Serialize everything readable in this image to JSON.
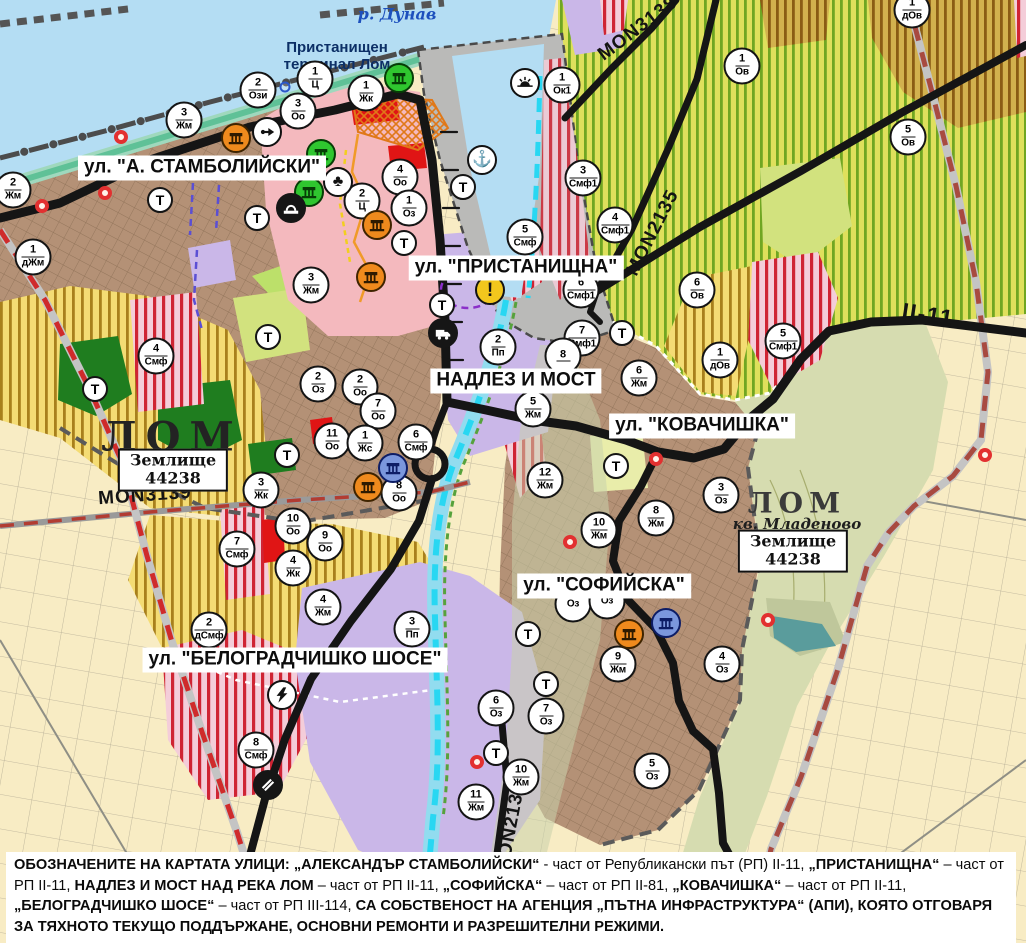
{
  "map_title": "Устройствен план – гр. Лом",
  "palette": {
    "water": "#b4ddf3",
    "river_channel": "#28d7f2",
    "residential_brown": "#b49176",
    "production_purple": "#cab7e8",
    "park_green": "#2fc62f",
    "mixed_function_stripe": "#cf2433",
    "agriculture_yellow": "#f4dc74",
    "vineyard_green": "#70a622",
    "central_pink": "#f4b9be",
    "port_gray": "#babab8",
    "road_black": "#151515",
    "railway_red": "#cf2b2b"
  },
  "street_labels": [
    {
      "text": "ул. \"А. СТАМБОЛИЙСКИ\"",
      "x": 202,
      "y": 168
    },
    {
      "text": "ул. \"ПРИСТАНИЩНА\"",
      "x": 516,
      "y": 268
    },
    {
      "text": "НАДЛЕЗ И МОСТ",
      "x": 516,
      "y": 381
    },
    {
      "text": "ул. \"КОВАЧИШКА\"",
      "x": 702,
      "y": 426
    },
    {
      "text": "ул. \"СОФИЙСКА\"",
      "x": 604,
      "y": 586
    },
    {
      "text": "ул. \"БЕЛОГРАДЧИШКО ШОСЕ\"",
      "x": 295,
      "y": 660
    }
  ],
  "road_labels": [
    {
      "text": "MON3139",
      "x": 145,
      "y": 496,
      "rot": -4
    },
    {
      "text": "MON3138",
      "x": 638,
      "y": 29,
      "rot": -37
    },
    {
      "text": "MON2135",
      "x": 653,
      "y": 233,
      "rot": -63
    },
    {
      "text": "MON2136",
      "x": 511,
      "y": 828,
      "rot": -79
    },
    {
      "text": "II-11",
      "x": 928,
      "y": 315,
      "rot": 9,
      "cls": "big"
    }
  ],
  "place_labels": [
    {
      "text": "р. Дунав",
      "x": 397,
      "y": 14,
      "cls": "river-name",
      "name": "danube-river-label"
    },
    {
      "text": "Пристанищен\nтерминал Лом",
      "x": 337,
      "y": 56,
      "cls": "terminal",
      "name": "port-terminal-label"
    },
    {
      "text": "ЛОМ",
      "x": 172,
      "y": 437,
      "cls": "city-large",
      "name": "city-label-lom"
    },
    {
      "text": "ЛОМ",
      "x": 797,
      "y": 503,
      "cls": "city-small",
      "name": "city-label-lom-mladenovo"
    },
    {
      "text": "кв. Младеново",
      "x": 797,
      "y": 524,
      "cls": "quarter",
      "name": "quarter-mladenovo-label"
    }
  ],
  "land_boxes": [
    {
      "line1": "Землище",
      "line2": "44238",
      "x": 173,
      "y": 470
    },
    {
      "line1": "Землище",
      "line2": "44238",
      "x": 793,
      "y": 551
    }
  ],
  "markers": {
    "zone": [
      {
        "num": "2",
        "code": "Ози",
        "x": 258,
        "y": 90
      },
      {
        "num": "1",
        "code": "Ц",
        "x": 315,
        "y": 79
      },
      {
        "num": "1",
        "code": "Жк",
        "x": 366,
        "y": 93
      },
      {
        "num": "3",
        "code": "Оо",
        "x": 298,
        "y": 111
      },
      {
        "num": "3",
        "code": "Жм",
        "x": 184,
        "y": 120
      },
      {
        "num": "2",
        "code": "Жм",
        "x": 13,
        "y": 190
      },
      {
        "num": "1",
        "code": "дЖм",
        "x": 33,
        "y": 257
      },
      {
        "num": "4",
        "code": "Оо",
        "x": 400,
        "y": 177
      },
      {
        "num": "2",
        "code": "Ц",
        "x": 362,
        "y": 201
      },
      {
        "num": "1",
        "code": "Оз",
        "x": 409,
        "y": 208
      },
      {
        "num": "3",
        "code": "Жм",
        "x": 311,
        "y": 285
      },
      {
        "num": "1",
        "code": "Ок1",
        "x": 562,
        "y": 85
      },
      {
        "num": "3",
        "code": "Смф1",
        "x": 583,
        "y": 178
      },
      {
        "num": "4",
        "code": "Смф1",
        "x": 615,
        "y": 225
      },
      {
        "num": "5",
        "code": "Смф",
        "x": 525,
        "y": 237
      },
      {
        "num": "6",
        "code": "Смф1",
        "x": 581,
        "y": 290
      },
      {
        "num": "7",
        "code": "Смф1",
        "x": 582,
        "y": 338
      },
      {
        "num": "8",
        "code": "",
        "x": 563,
        "y": 356
      },
      {
        "num": "1",
        "code": "Ов",
        "x": 742,
        "y": 66
      },
      {
        "num": "1",
        "code": "дОв",
        "x": 912,
        "y": 10
      },
      {
        "num": "5",
        "code": "Ов",
        "x": 908,
        "y": 137
      },
      {
        "num": "6",
        "code": "Ов",
        "x": 697,
        "y": 290
      },
      {
        "num": "1",
        "code": "дОв",
        "x": 720,
        "y": 360
      },
      {
        "num": "5",
        "code": "Смф1",
        "x": 783,
        "y": 341
      },
      {
        "num": "2",
        "code": "Пп",
        "x": 498,
        "y": 347
      },
      {
        "num": "6",
        "code": "Жм",
        "x": 639,
        "y": 378
      },
      {
        "num": "5",
        "code": "Жм",
        "x": 533,
        "y": 409
      },
      {
        "num": "6",
        "code": "Смф",
        "x": 416,
        "y": 442
      },
      {
        "num": "12",
        "code": "Жм",
        "x": 545,
        "y": 480
      },
      {
        "num": "2",
        "code": "Оз",
        "x": 318,
        "y": 384
      },
      {
        "num": "2",
        "code": "Оо",
        "x": 360,
        "y": 387
      },
      {
        "num": "7",
        "code": "Оо",
        "x": 378,
        "y": 411
      },
      {
        "num": "11",
        "code": "Оо",
        "x": 332,
        "y": 441
      },
      {
        "num": "1",
        "code": "Жс",
        "x": 365,
        "y": 443
      },
      {
        "num": "8",
        "code": "Оо",
        "x": 399,
        "y": 493
      },
      {
        "num": "3",
        "code": "Жк",
        "x": 261,
        "y": 490
      },
      {
        "num": "10",
        "code": "Оо",
        "x": 293,
        "y": 526
      },
      {
        "num": "9",
        "code": "Оо",
        "x": 325,
        "y": 543
      },
      {
        "num": "4",
        "code": "Жк",
        "x": 293,
        "y": 568
      },
      {
        "num": "7",
        "code": "Смф",
        "x": 237,
        "y": 549
      },
      {
        "num": "4",
        "code": "Смф",
        "x": 156,
        "y": 356
      },
      {
        "num": "4",
        "code": "Жм",
        "x": 323,
        "y": 607
      },
      {
        "num": "2",
        "code": "дСмф",
        "x": 209,
        "y": 630
      },
      {
        "num": "3",
        "code": "Пп",
        "x": 412,
        "y": 629
      },
      {
        "num": "8",
        "code": "Смф",
        "x": 256,
        "y": 750
      },
      {
        "num": "10",
        "code": "Жм",
        "x": 599,
        "y": 530
      },
      {
        "num": "8",
        "code": "Жм",
        "x": 656,
        "y": 518
      },
      {
        "num": "3",
        "code": "Оз",
        "x": 721,
        "y": 495
      },
      {
        "num": "",
        "code": "Оз",
        "x": 573,
        "y": 604
      },
      {
        "num": "",
        "code": "Оз",
        "x": 607,
        "y": 601
      },
      {
        "num": "9",
        "code": "Жм",
        "x": 618,
        "y": 664
      },
      {
        "num": "4",
        "code": "Оз",
        "x": 722,
        "y": 664
      },
      {
        "num": "6",
        "code": "Оз",
        "x": 496,
        "y": 708
      },
      {
        "num": "7",
        "code": "Оз",
        "x": 546,
        "y": 716
      },
      {
        "num": "10",
        "code": "Жм",
        "x": 521,
        "y": 777
      },
      {
        "num": "11",
        "code": "Жм",
        "x": 476,
        "y": 802
      },
      {
        "num": "5",
        "code": "Оз",
        "x": 652,
        "y": 771
      }
    ],
    "transport": [
      {
        "label": "Т",
        "x": 160,
        "y": 200
      },
      {
        "label": "Т",
        "x": 257,
        "y": 218
      },
      {
        "label": "Т",
        "x": 404,
        "y": 243
      },
      {
        "label": "Т",
        "x": 442,
        "y": 305
      },
      {
        "label": "Т",
        "x": 463,
        "y": 187
      },
      {
        "label": "Т",
        "x": 622,
        "y": 333
      },
      {
        "label": "Т",
        "x": 95,
        "y": 389
      },
      {
        "label": "Т",
        "x": 268,
        "y": 337
      },
      {
        "label": "Т",
        "x": 287,
        "y": 455
      },
      {
        "label": "Т",
        "x": 616,
        "y": 466
      },
      {
        "label": "Т",
        "x": 528,
        "y": 634
      },
      {
        "label": "Т",
        "x": 546,
        "y": 684
      },
      {
        "label": "Т",
        "x": 496,
        "y": 753
      }
    ],
    "icons": [
      {
        "icon": "monument",
        "variant": "orange",
        "name": "single-cultural-monument-icon",
        "x": 236,
        "y": 138
      },
      {
        "icon": "monument",
        "variant": "orange",
        "name": "single-cultural-monument-icon",
        "x": 377,
        "y": 225
      },
      {
        "icon": "monument",
        "variant": "orange",
        "name": "single-cultural-monument-icon",
        "x": 371,
        "y": 277
      },
      {
        "icon": "monument",
        "variant": "orange",
        "name": "single-cultural-monument-icon",
        "x": 368,
        "y": 487
      },
      {
        "icon": "monument",
        "variant": "orange",
        "name": "single-cultural-monument-icon",
        "x": 629,
        "y": 634
      },
      {
        "icon": "monument",
        "variant": "green",
        "name": "group-cultural-monument-icon",
        "x": 399,
        "y": 78
      },
      {
        "icon": "monument",
        "variant": "green",
        "name": "group-cultural-monument-icon",
        "x": 321,
        "y": 154
      },
      {
        "icon": "monument",
        "variant": "green",
        "name": "group-cultural-monument-icon",
        "x": 309,
        "y": 192
      },
      {
        "icon": "monument",
        "variant": "blue",
        "name": "memorial-monument-icon",
        "x": 393,
        "y": 468
      },
      {
        "icon": "monument",
        "variant": "blue",
        "name": "memorial-monument-icon",
        "x": 666,
        "y": 623
      },
      {
        "icon": "anchor",
        "variant": "white",
        "name": "port-anchor-icon",
        "x": 482,
        "y": 160
      },
      {
        "icon": "club",
        "variant": "white",
        "name": "public-services-icon",
        "x": 338,
        "y": 182
      },
      {
        "icon": "arrow",
        "variant": "white",
        "name": "one-way-route-icon",
        "x": 267,
        "y": 132
      },
      {
        "icon": "tunnel",
        "variant": "black",
        "name": "tunnel-icon",
        "x": 291,
        "y": 208
      },
      {
        "icon": "sun",
        "variant": "white",
        "name": "waterfront-leisure-icon",
        "x": 525,
        "y": 83
      },
      {
        "icon": "warning",
        "variant": "yellow",
        "name": "hazard-warning-icon",
        "x": 490,
        "y": 290
      },
      {
        "icon": "truck",
        "variant": "black",
        "name": "freight-terminal-icon",
        "x": 443,
        "y": 333
      },
      {
        "icon": "lightning",
        "variant": "white",
        "name": "power-substation-icon",
        "x": 282,
        "y": 695
      },
      {
        "icon": "crossing",
        "variant": "black",
        "name": "railway-crossing-icon",
        "x": 268,
        "y": 785
      }
    ],
    "red_rings": [
      {
        "x": 121,
        "y": 137
      },
      {
        "x": 105,
        "y": 193
      },
      {
        "x": 42,
        "y": 206
      },
      {
        "x": 656,
        "y": 459
      },
      {
        "x": 570,
        "y": 542
      },
      {
        "x": 477,
        "y": 762
      },
      {
        "x": 768,
        "y": 620
      },
      {
        "x": 985,
        "y": 455
      }
    ],
    "blue_rings": [
      {
        "x": 285,
        "y": 87
      }
    ]
  },
  "note": {
    "segments": [
      {
        "t": "ОБОЗНАЧЕНИТЕ НА КАРТАТА УЛИЦИ: „АЛЕКСАНДЪР СТАМБОЛИЙСКИ“",
        "b": true
      },
      {
        "t": " - част от Републикански път (РП) II-11, ",
        "b": false
      },
      {
        "t": "„ПРИСТАНИЩНА“",
        "b": true
      },
      {
        "t": " – част от РП II-11, ",
        "b": false
      },
      {
        "t": "НАДЛЕЗ И МОСТ НАД РЕКА ЛОМ",
        "b": true
      },
      {
        "t": " – част от РП II-11, ",
        "b": false
      },
      {
        "t": "„СОФИЙСКА“",
        "b": true
      },
      {
        "t": " – част от РП II-81, ",
        "b": false
      },
      {
        "t": "„КОВАЧИШКА“",
        "b": true
      },
      {
        "t": " – част от РП II-11, ",
        "b": false
      },
      {
        "t": "„БЕЛОГРАДЧИШКО ШОСЕ“",
        "b": true
      },
      {
        "t": " – част от РП III-114, ",
        "b": false
      },
      {
        "t": "СА СОБСТВЕНОСТ НА АГЕНЦИЯ „ПЪТНА ИНФРАСТРУКТУРА“ (АПИ), КОЯТО ОТГОВАРЯ ЗА ТЯХНОТО ТЕКУЩО ПОДДЪРЖАНЕ, ОСНОВНИ РЕМОНТИ И РАЗРЕШИТЕЛНИ РЕЖИМИ.",
        "b": true
      }
    ]
  }
}
